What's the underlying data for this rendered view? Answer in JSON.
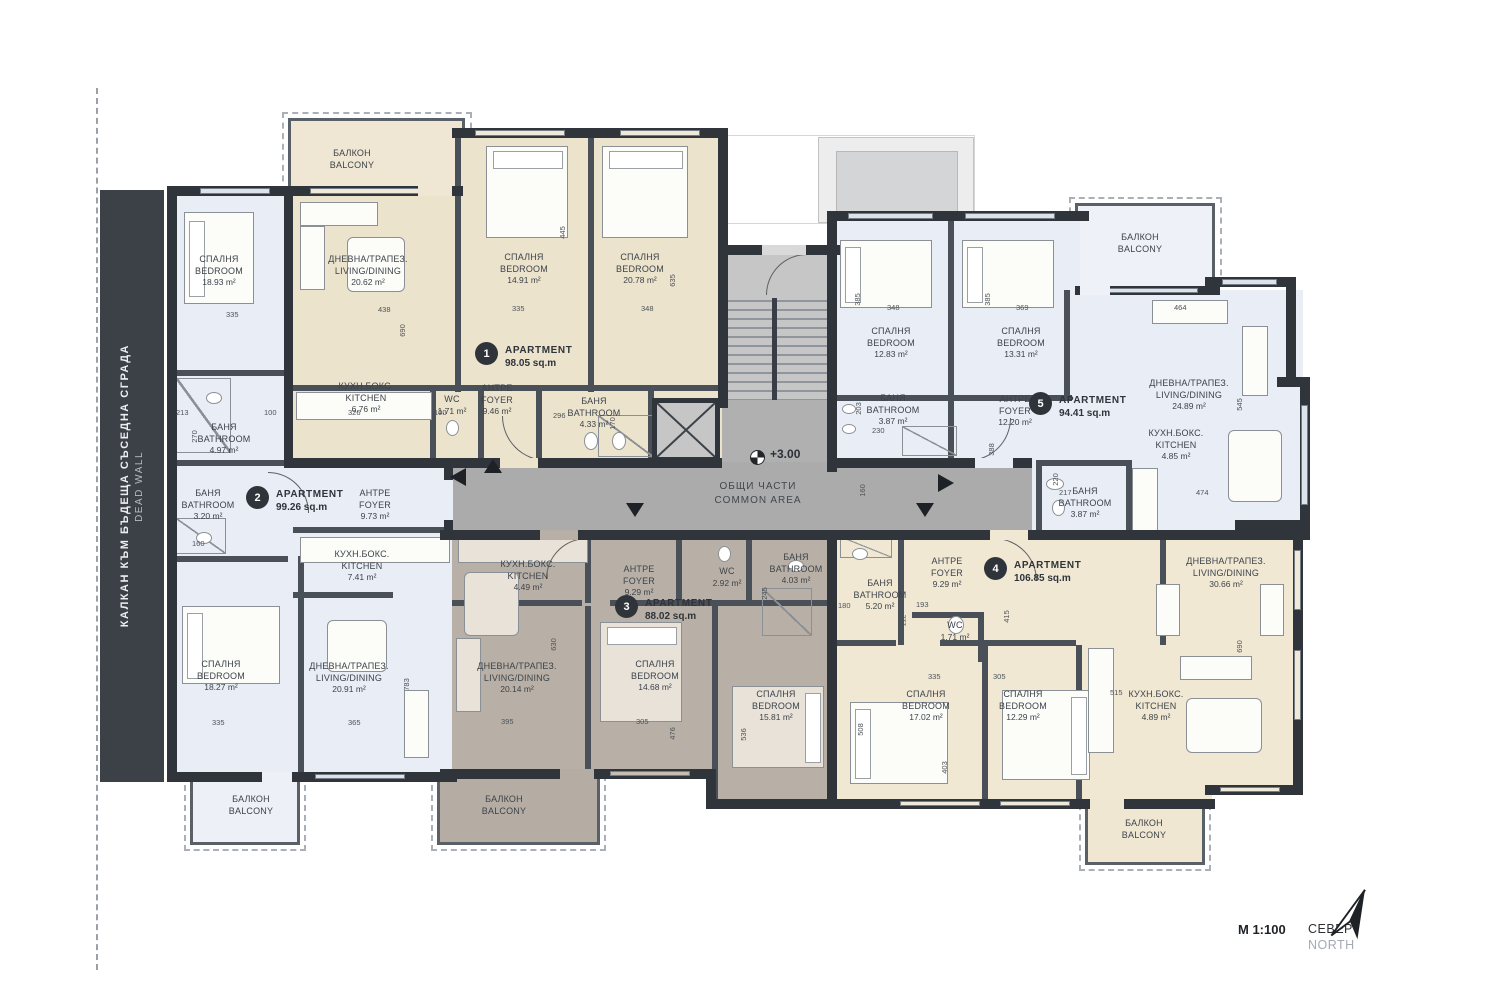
{
  "dead_wall": {
    "line_bg": "КАЛКАН КЪМ БЪДЕЩА СЪСЕДНА СГРАДА",
    "line_en": "DEAD WALL"
  },
  "common": {
    "level_mark": "+3.00",
    "name_bg": "ОБЩИ ЧАСТИ",
    "name_en": "COMMON AREA"
  },
  "balcony_label": {
    "bg": "БАЛКОН",
    "en": "BALCONY"
  },
  "legend": {
    "scale": "М 1:100",
    "north_bg": "СЕВЕР",
    "north_en": "NORTH"
  },
  "apartments": [
    {
      "num": "1",
      "label": "APARTMENT",
      "area": "98.05 sq.m"
    },
    {
      "num": "2",
      "label": "APARTMENT",
      "area": "99.26 sq.m"
    },
    {
      "num": "3",
      "label": "APARTMENT",
      "area": "88.02 sq.m"
    },
    {
      "num": "4",
      "label": "APARTMENT",
      "area": "106.85 sq.m"
    },
    {
      "num": "5",
      "label": "APARTMENT",
      "area": "94.41 sq.m"
    }
  ],
  "rooms": [
    {
      "bg": "СПАЛНЯ",
      "en": "BEDROOM",
      "area": "18.93 m²"
    },
    {
      "bg": "ДНЕВНА/ТРАПЕЗ.",
      "en": "LIVING/DINING",
      "area": "20.62 m²"
    },
    {
      "bg": "СПАЛНЯ",
      "en": "BEDROOM",
      "area": "14.91 m²"
    },
    {
      "bg": "СПАЛНЯ",
      "en": "BEDROOM",
      "area": "20.78 m²"
    },
    {
      "bg": "КУХН.БОКС.",
      "en": "KITCHEN",
      "area": "6.76 m²"
    },
    {
      "bg": "WC",
      "en": "",
      "area": "1.71 m²"
    },
    {
      "bg": "АНТРЕ",
      "en": "FOYER",
      "area": "9.46 m²"
    },
    {
      "bg": "БАНЯ",
      "en": "BATHROOM",
      "area": "4.33 m²"
    },
    {
      "bg": "БАНЯ",
      "en": "BATHROOM",
      "area": "4.97 m²"
    },
    {
      "bg": "БАНЯ",
      "en": "BATHROOM",
      "area": "3.20 m²"
    },
    {
      "bg": "АНТРЕ",
      "en": "FOYER",
      "area": "9.73 m²"
    },
    {
      "bg": "КУХН.БОКС.",
      "en": "KITCHEN",
      "area": "7.41 m²"
    },
    {
      "bg": "СПАЛНЯ",
      "en": "BEDROOM",
      "area": "18.27 m²"
    },
    {
      "bg": "ДНЕВНА/ТРАПЕЗ.",
      "en": "LIVING/DINING",
      "area": "20.91 m²"
    },
    {
      "bg": "КУХН.БОКС.",
      "en": "KITCHEN",
      "area": "4.49 m²"
    },
    {
      "bg": "АНТРЕ",
      "en": "FOYER",
      "area": "9.29 m²"
    },
    {
      "bg": "WC",
      "en": "",
      "area": "2.92 m²"
    },
    {
      "bg": "БАНЯ",
      "en": "BATHROOM",
      "area": "4.03 m²"
    },
    {
      "bg": "ДНЕВНА/ТРАПЕЗ.",
      "en": "LIVING/DINING",
      "area": "20.14 m²"
    },
    {
      "bg": "СПАЛНЯ",
      "en": "BEDROOM",
      "area": "14.68 m²"
    },
    {
      "bg": "СПАЛНЯ",
      "en": "BEDROOM",
      "area": "15.81 m²"
    },
    {
      "bg": "СПАЛНЯ",
      "en": "BEDROOM",
      "area": "12.83 m²"
    },
    {
      "bg": "СПАЛНЯ",
      "en": "BEDROOM",
      "area": "13.31 m²"
    },
    {
      "bg": "БАНЯ",
      "en": "BATHROOM",
      "area": "3.87 m²"
    },
    {
      "bg": "АНТРЕ",
      "en": "FOYER",
      "area": "12.20 m²"
    },
    {
      "bg": "ДНЕВНА/ТРАПЕЗ.",
      "en": "LIVING/DINING",
      "area": "24.89 m²"
    },
    {
      "bg": "КУХН.БОКС.",
      "en": "KITCHEN",
      "area": "4.85 m²"
    },
    {
      "bg": "БАНЯ",
      "en": "BATHROOM",
      "area": "3.87 m²"
    },
    {
      "bg": "АНТРЕ",
      "en": "FOYER",
      "area": "9.29 m²"
    },
    {
      "bg": "БАНЯ",
      "en": "BATHROOM",
      "area": "5.20 m²"
    },
    {
      "bg": "WC",
      "en": "",
      "area": "1.71 m²"
    },
    {
      "bg": "СПАЛНЯ",
      "en": "BEDROOM",
      "area": "17.02 m²"
    },
    {
      "bg": "СПАЛНЯ",
      "en": "BEDROOM",
      "area": "12.29 m²"
    },
    {
      "bg": "КУХН.БОКС.",
      "en": "KITCHEN",
      "area": "4.89 m²"
    },
    {
      "bg": "ДНЕВНА/ТРАПЕЗ.",
      "en": "LIVING/DINING",
      "area": "30.66 m²"
    }
  ],
  "dims": [
    "335",
    "438",
    "690",
    "213",
    "100",
    "326",
    "270",
    "160",
    "335",
    "365",
    "783",
    "445",
    "335",
    "348",
    "635",
    "296",
    "170",
    "100",
    "385",
    "348",
    "385",
    "369",
    "464",
    "545",
    "474",
    "203",
    "230",
    "160",
    "220",
    "217",
    "630",
    "395",
    "305",
    "476",
    "536",
    "508",
    "335",
    "305",
    "403",
    "415",
    "193",
    "112",
    "515",
    "690",
    "388",
    "190",
    "245",
    "180"
  ]
}
